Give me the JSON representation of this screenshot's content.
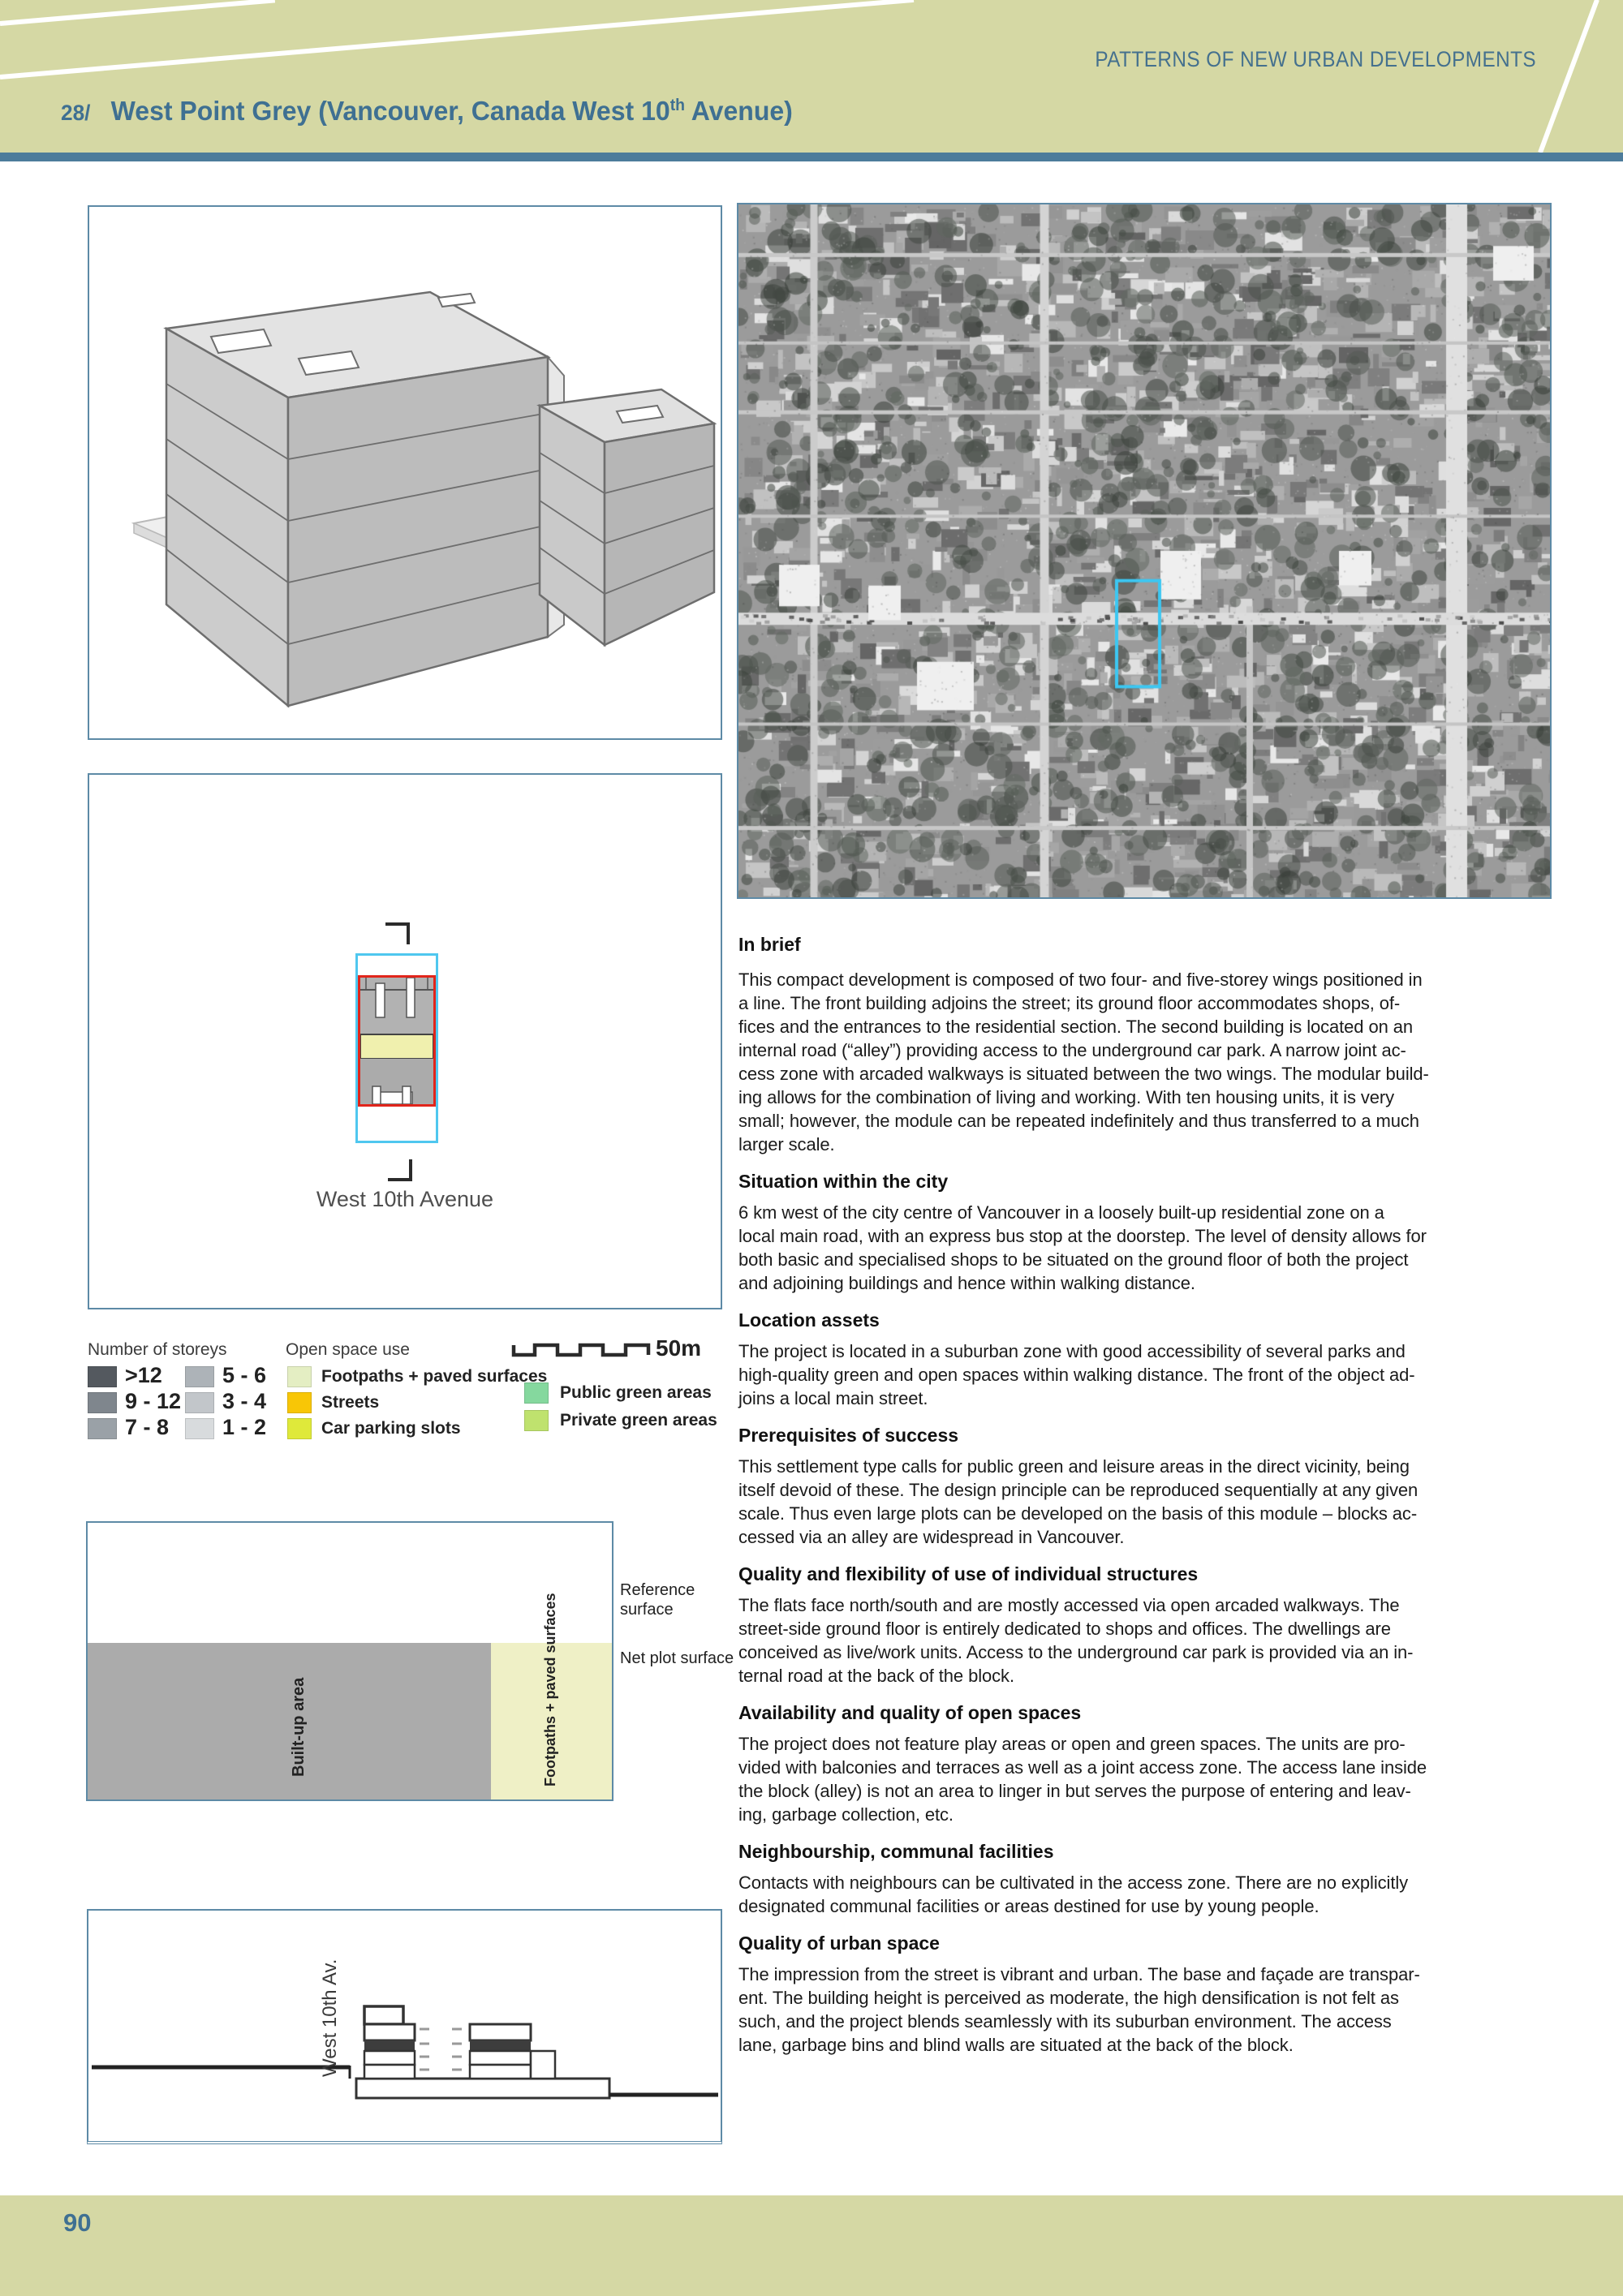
{
  "header": {
    "running_title": "PATTERNS OF NEW URBAN DEVELOPMENTS",
    "case_number": "28/",
    "title_start": "West Point Grey (Vancouver, Canada West 10",
    "title_sup": "th",
    "title_end": " Avenue)"
  },
  "footer": {
    "page_number": "90"
  },
  "figures": {
    "site_plan": {
      "street_label": "West 10th Avenue"
    },
    "elevation": {
      "street_label": "West 10th Av."
    },
    "aerial": {
      "highlight_color": "#3cc7f2"
    }
  },
  "legend": {
    "storeys": {
      "title": "Number of storeys",
      "items": [
        {
          "label": ">12",
          "color": "#54595f"
        },
        {
          "label": "9 - 12",
          "color": "#7f868d"
        },
        {
          "label": "7 - 8",
          "color": "#9aa1a7"
        },
        {
          "label": "5 - 6",
          "color": "#adb3b8"
        },
        {
          "label": "3 - 4",
          "color": "#c2c6ca"
        },
        {
          "label": "1 - 2",
          "color": "#d8dbdd"
        }
      ]
    },
    "open_space": {
      "title": "Open space use",
      "items": [
        {
          "label": "Footpaths + paved surfaces",
          "color": "#e4eec3"
        },
        {
          "label": "Streets",
          "color": "#f8c606"
        },
        {
          "label": "Car parking slots",
          "color": "#dfe93a"
        }
      ]
    },
    "green": {
      "items": [
        {
          "label": "Public green areas",
          "color": "#85d89e"
        },
        {
          "label": "Private green areas",
          "color": "#bfe26e"
        }
      ]
    },
    "scale_label": "50m"
  },
  "chart_data": {
    "type": "area",
    "title": "Land use shares of the reference surface",
    "labels": {
      "reference": "Reference surface",
      "net_plot": "Net plot surface",
      "built_up": "Built-up area",
      "footpaths": "Footpaths + paved surfaces"
    },
    "net_plot_height_fraction": 0.565,
    "built_up_width_fraction": 0.77,
    "footpaths_width_fraction": 0.23
  },
  "sections": [
    {
      "heading": "In brief",
      "lines": [
        "This compact development is composed of two four- and five-storey wings positioned in",
        "a line. The front building adjoins the street; its ground floor accommodates shops, of-",
        "fices and the entrances to the residential section. The second building is located on an",
        "internal road (“alley”) providing access to the underground car park. A narrow joint ac-",
        "cess zone with arcaded walkways is situated between the two wings. The modular build-",
        "ing allows for the combination of living and working. With ten housing units, it is very",
        "small; however, the module can be repeated indefinitely and thus transferred to a much",
        "larger scale."
      ]
    },
    {
      "heading": "Situation within the city",
      "lines": [
        "6 km west of the city centre of Vancouver in a loosely built-up residential zone on a",
        "local main road, with an express bus stop at the doorstep. The level of density allows for",
        "both basic and specialised shops to be situated on the ground floor of both the project",
        "and adjoining buildings and hence within walking distance."
      ]
    },
    {
      "heading": "Location assets",
      "lines": [
        "The project is located in a suburban zone with good accessibility of several parks and",
        "high-quality green and open spaces within walking distance. The front of the object ad-",
        "joins a local main street."
      ]
    },
    {
      "heading": "Prerequisites of success",
      "lines": [
        "This settlement type calls for public green and leisure areas in the direct vicinity, being",
        "itself devoid of these. The design principle can be reproduced sequentially at any given",
        "scale. Thus even large plots can be developed on the basis of this module – blocks ac-",
        "cessed via an alley are widespread in Vancouver."
      ]
    },
    {
      "heading": "Quality and flexibility of use of individual structures",
      "lines": [
        "The flats face north/south and are mostly accessed via open arcaded walkways. The",
        "street-side ground floor is entirely dedicated to shops and offices. The dwellings are",
        "conceived as live/work units. Access to the underground car park is provided via an in-",
        "ternal road at the back of the block."
      ]
    },
    {
      "heading": "Availability and quality of open spaces",
      "lines": [
        "The project does not feature play areas or open and green spaces. The units are pro-",
        "vided with balconies and terraces as well as a joint access zone. The access lane inside",
        "the block (alley) is not an area to linger in but serves the purpose of entering and leav-",
        "ing, garbage collection, etc."
      ]
    },
    {
      "heading": "Neighbourship, communal facilities",
      "lines": [
        "Contacts with neighbours can be cultivated in the access zone. There are no explicitly",
        "designated communal facilities or areas destined for use by young people."
      ]
    },
    {
      "heading": "Quality of urban space",
      "lines": [
        "The impression from the street is vibrant and urban. The base and façade are transpar-",
        "ent. The building height is perceived as moderate, the high densification is not felt as",
        "such, and the project blends seamlessly with its suburban environment. The access",
        "lane, garbage bins and blind walls are situated at the back of the block."
      ]
    }
  ]
}
